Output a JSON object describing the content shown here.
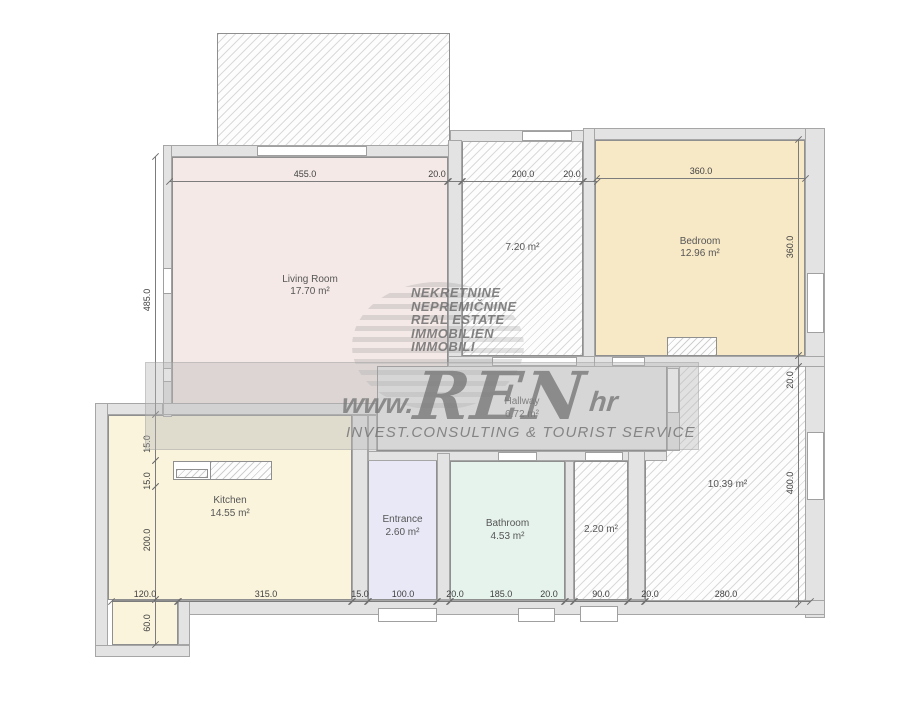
{
  "page": {
    "title": "Floor plan"
  },
  "watermark": {
    "language_lines": [
      "NEKRETNINE",
      "NEPREMIČNINE",
      "REAL ESTATE",
      "IMMOBILIEN",
      "IMMOBILI"
    ],
    "url_prefix": "www.",
    "brand": "REN",
    "url_suffix": "hr",
    "tagline": "INVEST.CONSULTING & TOURIST SERVICE"
  },
  "rooms": [
    {
      "id": "balcony",
      "name": "",
      "area": "",
      "x": 217,
      "y": 33,
      "w": 233,
      "h": 122,
      "fill": "hatch"
    },
    {
      "id": "room-1039",
      "name": "",
      "area": "10.39 m²",
      "x": 645,
      "y": 366,
      "w": 165,
      "h": 239,
      "fill": "hatch"
    },
    {
      "id": "living-room",
      "name": "Living Room",
      "area": "17.70 m²",
      "x": 172,
      "y": 157,
      "w": 276,
      "h": 258,
      "fill": "#f4e9e7"
    },
    {
      "id": "room-720",
      "name": "",
      "area": "7.20 m²",
      "x": 462,
      "y": 140,
      "w": 121,
      "h": 216,
      "fill": "hatch"
    },
    {
      "id": "bedroom",
      "name": "Bedroom",
      "area": "12.96 m²",
      "x": 595,
      "y": 140,
      "w": 210,
      "h": 216,
      "fill": "#f7e8c6"
    },
    {
      "id": "kitchen",
      "name": "Kitchen",
      "area": "14.55 m²",
      "x": 108,
      "y": 415,
      "w": 244,
      "h": 185,
      "fill": "#faf4dc"
    },
    {
      "id": "hallway",
      "name": "Hallway",
      "area": "6.72 m²",
      "x": 377,
      "y": 366,
      "w": 290,
      "h": 85,
      "fill": "#ebebeb"
    },
    {
      "id": "entrance",
      "name": "Entrance",
      "area": "2.60 m²",
      "x": 368,
      "y": 453,
      "w": 69,
      "h": 147,
      "fill": "#e8e8f7"
    },
    {
      "id": "bathroom",
      "name": "Bathroom",
      "area": "4.53 m²",
      "x": 450,
      "y": 461,
      "w": 115,
      "h": 139,
      "fill": "#e6f3ec"
    },
    {
      "id": "room-220",
      "name": "",
      "area": "2.20 m²",
      "x": 574,
      "y": 461,
      "w": 54,
      "h": 139,
      "fill": "hatch"
    },
    {
      "id": "entry-nook",
      "name": "",
      "area": "",
      "x": 112,
      "y": 600,
      "w": 66,
      "h": 45,
      "fill": "#faf4dc"
    }
  ],
  "dimensions": [
    {
      "label": "455.0",
      "dir": "h",
      "x": 170,
      "y": 181,
      "len": 278,
      "lx": 305,
      "ly": 174
    },
    {
      "label": "20.0",
      "dir": "h",
      "x": 448,
      "y": 181,
      "len": 14,
      "lx": 437,
      "ly": 174
    },
    {
      "label": "200.0",
      "dir": "h",
      "x": 462,
      "y": 181,
      "len": 121,
      "lx": 523,
      "ly": 174
    },
    {
      "label": "20.0",
      "dir": "h",
      "x": 583,
      "y": 181,
      "len": 14,
      "lx": 572,
      "ly": 174
    },
    {
      "label": "360.0",
      "dir": "h",
      "x": 597,
      "y": 178,
      "len": 208,
      "lx": 701,
      "ly": 171
    },
    {
      "label": "485.0",
      "dir": "v",
      "x": 155,
      "y": 157,
      "len": 258,
      "lx": 147,
      "ly": 300
    },
    {
      "label": "15.0",
      "dir": "v",
      "x": 155,
      "y": 415,
      "len": 46,
      "lx": 147,
      "ly": 444
    },
    {
      "label": "15.0",
      "dir": "v",
      "x": 155,
      "y": 461,
      "len": 26,
      "lx": 147,
      "ly": 481
    },
    {
      "label": "200.0",
      "dir": "v",
      "x": 155,
      "y": 487,
      "len": 113,
      "lx": 147,
      "ly": 540
    },
    {
      "label": "60.0",
      "dir": "v",
      "x": 155,
      "y": 600,
      "len": 45,
      "lx": 147,
      "ly": 623
    },
    {
      "label": "360.0",
      "dir": "v",
      "x": 798,
      "y": 140,
      "len": 216,
      "lx": 790,
      "ly": 247
    },
    {
      "label": "20.0",
      "dir": "v",
      "x": 798,
      "y": 356,
      "len": 11,
      "lx": 790,
      "ly": 380
    },
    {
      "label": "400.0",
      "dir": "v",
      "x": 798,
      "y": 367,
      "len": 238,
      "lx": 790,
      "ly": 483
    },
    {
      "label": "120.0",
      "dir": "h",
      "x": 112,
      "y": 601,
      "len": 66,
      "lx": 145,
      "ly": 594
    },
    {
      "label": "315.0",
      "dir": "h",
      "x": 178,
      "y": 601,
      "len": 174,
      "lx": 266,
      "ly": 594
    },
    {
      "label": "15.0",
      "dir": "h",
      "x": 352,
      "y": 601,
      "len": 16,
      "lx": 360,
      "ly": 594
    },
    {
      "label": "100.0",
      "dir": "h",
      "x": 368,
      "y": 601,
      "len": 69,
      "lx": 403,
      "ly": 594
    },
    {
      "label": "20.0",
      "dir": "h",
      "x": 437,
      "y": 601,
      "len": 13,
      "lx": 455,
      "ly": 594
    },
    {
      "label": "185.0",
      "dir": "h",
      "x": 450,
      "y": 601,
      "len": 115,
      "lx": 501,
      "ly": 594
    },
    {
      "label": "20.0",
      "dir": "h",
      "x": 565,
      "y": 601,
      "len": 9,
      "lx": 549,
      "ly": 594
    },
    {
      "label": "90.0",
      "dir": "h",
      "x": 574,
      "y": 601,
      "len": 54,
      "lx": 601,
      "ly": 594
    },
    {
      "label": "20.0",
      "dir": "h",
      "x": 628,
      "y": 601,
      "len": 17,
      "lx": 650,
      "ly": 594
    },
    {
      "label": "280.0",
      "dir": "h",
      "x": 645,
      "y": 601,
      "len": 165,
      "lx": 726,
      "ly": 594
    }
  ]
}
